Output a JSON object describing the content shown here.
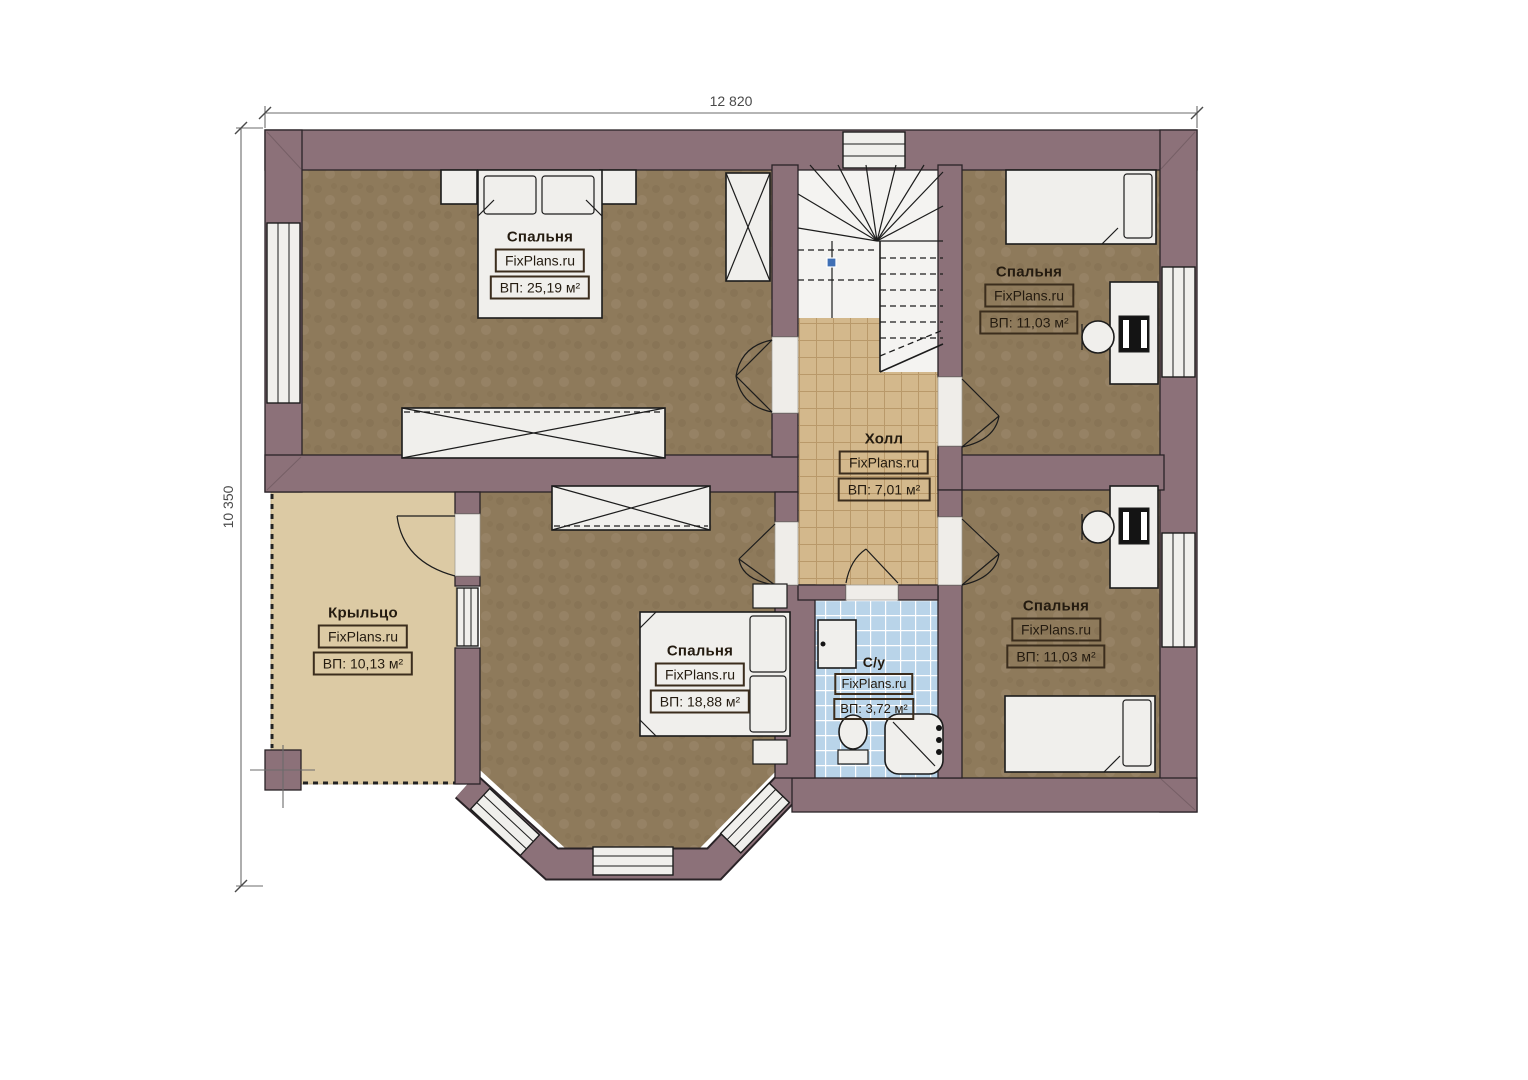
{
  "plan": {
    "width_label": "12 820",
    "height_label": "10 350",
    "watermark": "FixPlans.ru",
    "rooms": [
      {
        "id": "bedroom-master",
        "name": "Спальня",
        "area": "ВП: 25,19 м²"
      },
      {
        "id": "bedroom-top-right",
        "name": "Спальня",
        "area": "ВП: 11,03 м²"
      },
      {
        "id": "hall",
        "name": "Холл",
        "area": "ВП: 7,01 м²"
      },
      {
        "id": "porch",
        "name": "Крыльцо",
        "area": "ВП: 10,13 м²"
      },
      {
        "id": "bedroom-bottom",
        "name": "Спальня",
        "area": "ВП: 18,88 м²"
      },
      {
        "id": "bathroom",
        "name": "С/у",
        "area": "ВП: 3,72 м²"
      },
      {
        "id": "bedroom-bottom-right",
        "name": "Спальня",
        "area": "ВП: 11,03 м²"
      }
    ]
  },
  "colors": {
    "wall": "#8c7179",
    "wall_outline": "#2a2327",
    "floor_bedroom": "#8e7a5b",
    "floor_hall": "#d3b88c",
    "floor_hall_line": "#b9996a",
    "floor_bath": "#b9d4e9",
    "floor_bath_line": "#ffffff",
    "floor_porch": "#dccaa4",
    "furniture": "#f0efec",
    "line": "#1c1c1c",
    "dimension_text": "#4a4a4a",
    "marker_blue": "#3f6fb5"
  }
}
